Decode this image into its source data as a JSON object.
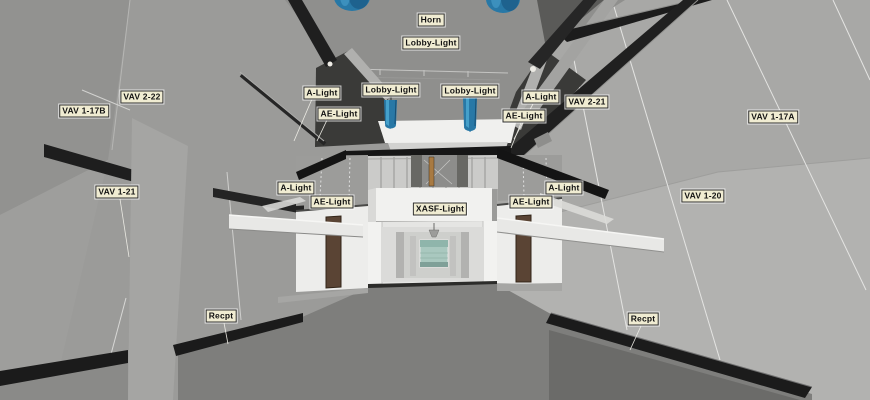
{
  "viewer": {
    "description": "3D building model interior view with element tags",
    "colors": {
      "wall_left": "#9b9b99",
      "wall_right": "#b2b2b0",
      "ceiling_gray": "#8f8f8d",
      "dark_panel": "#3a3a38",
      "beam_black": "#1c1c1c",
      "fascia_white": "#f0f0ee",
      "floor_main": "#7e7e7c",
      "floor_dark_corner": "#6b6b69",
      "door_brown": "#5a4434",
      "glass_green": "#a9c8bf",
      "horn_blue": "#2878a6",
      "tag_background": "#f0ecd2",
      "tag_border": "#2f2f2f",
      "tag_text": "#121212"
    }
  },
  "labels": [
    {
      "id": "horn",
      "text": "Horn",
      "x": 431,
      "y": 20
    },
    {
      "id": "lobby-light-top",
      "text": "Lobby-Light",
      "x": 431,
      "y": 43
    },
    {
      "id": "vav-2-22",
      "text": "VAV 2-22",
      "x": 142,
      "y": 97
    },
    {
      "id": "vav-1-17b",
      "text": "VAV 1-17B",
      "x": 84,
      "y": 111
    },
    {
      "id": "a-light-upper-left",
      "text": "A-Light",
      "x": 322,
      "y": 93
    },
    {
      "id": "lobby-light-left",
      "text": "Lobby-Light",
      "x": 391,
      "y": 90
    },
    {
      "id": "lobby-light-right",
      "text": "Lobby-Light",
      "x": 470,
      "y": 91
    },
    {
      "id": "a-light-upper-right",
      "text": "A-Light",
      "x": 541,
      "y": 97
    },
    {
      "id": "ae-light-upper-left",
      "text": "AE-Light",
      "x": 339,
      "y": 114
    },
    {
      "id": "ae-light-upper-right",
      "text": "AE-Light",
      "x": 524,
      "y": 116
    },
    {
      "id": "vav-2-21",
      "text": "VAV 2-21",
      "x": 587,
      "y": 102
    },
    {
      "id": "vav-1-17a",
      "text": "VAV 1-17A",
      "x": 773,
      "y": 117
    },
    {
      "id": "vav-1-21",
      "text": "VAV 1-21",
      "x": 117,
      "y": 192
    },
    {
      "id": "a-light-mid-left",
      "text": "A-Light",
      "x": 296,
      "y": 188
    },
    {
      "id": "ae-light-mid-left",
      "text": "AE-Light",
      "x": 332,
      "y": 202
    },
    {
      "id": "xasf-light",
      "text": "XASF-Light",
      "x": 440,
      "y": 209
    },
    {
      "id": "ae-light-mid-right",
      "text": "AE-Light",
      "x": 531,
      "y": 202
    },
    {
      "id": "a-light-mid-right",
      "text": "A-Light",
      "x": 564,
      "y": 188
    },
    {
      "id": "vav-1-20",
      "text": "VAV 1-20",
      "x": 703,
      "y": 196
    },
    {
      "id": "recpt-left",
      "text": "Recpt",
      "x": 221,
      "y": 316
    },
    {
      "id": "recpt-right",
      "text": "Recpt",
      "x": 643,
      "y": 319
    }
  ]
}
